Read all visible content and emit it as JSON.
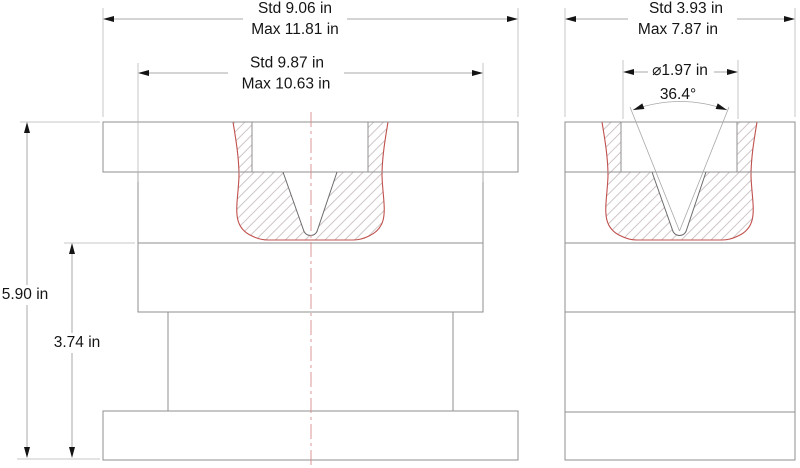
{
  "dimensions": {
    "front_overall_width": {
      "std": "Std 9.06 in",
      "max": "Max 11.81 in"
    },
    "front_body_width": {
      "std": "Std 9.87 in",
      "max": "Max 10.63 in"
    },
    "side_overall_width": {
      "std": "Std 3.93 in",
      "max": "Max 7.87 in"
    },
    "die_opening_diameter": "⌀1.97 in",
    "vee_angle": "36.4°",
    "overall_height": "5.90 in",
    "upper_body_height": "3.74 in"
  },
  "colors": {
    "outline": "#8f8f8f",
    "dim": "#a8a8a8",
    "ext": "#b5b5b5",
    "text": "#141414",
    "red": "#c0504d",
    "center": "#d98c8c",
    "hatch": "#cfc6c6",
    "vee": "#6b6b6b",
    "bg": "#ffffff"
  }
}
